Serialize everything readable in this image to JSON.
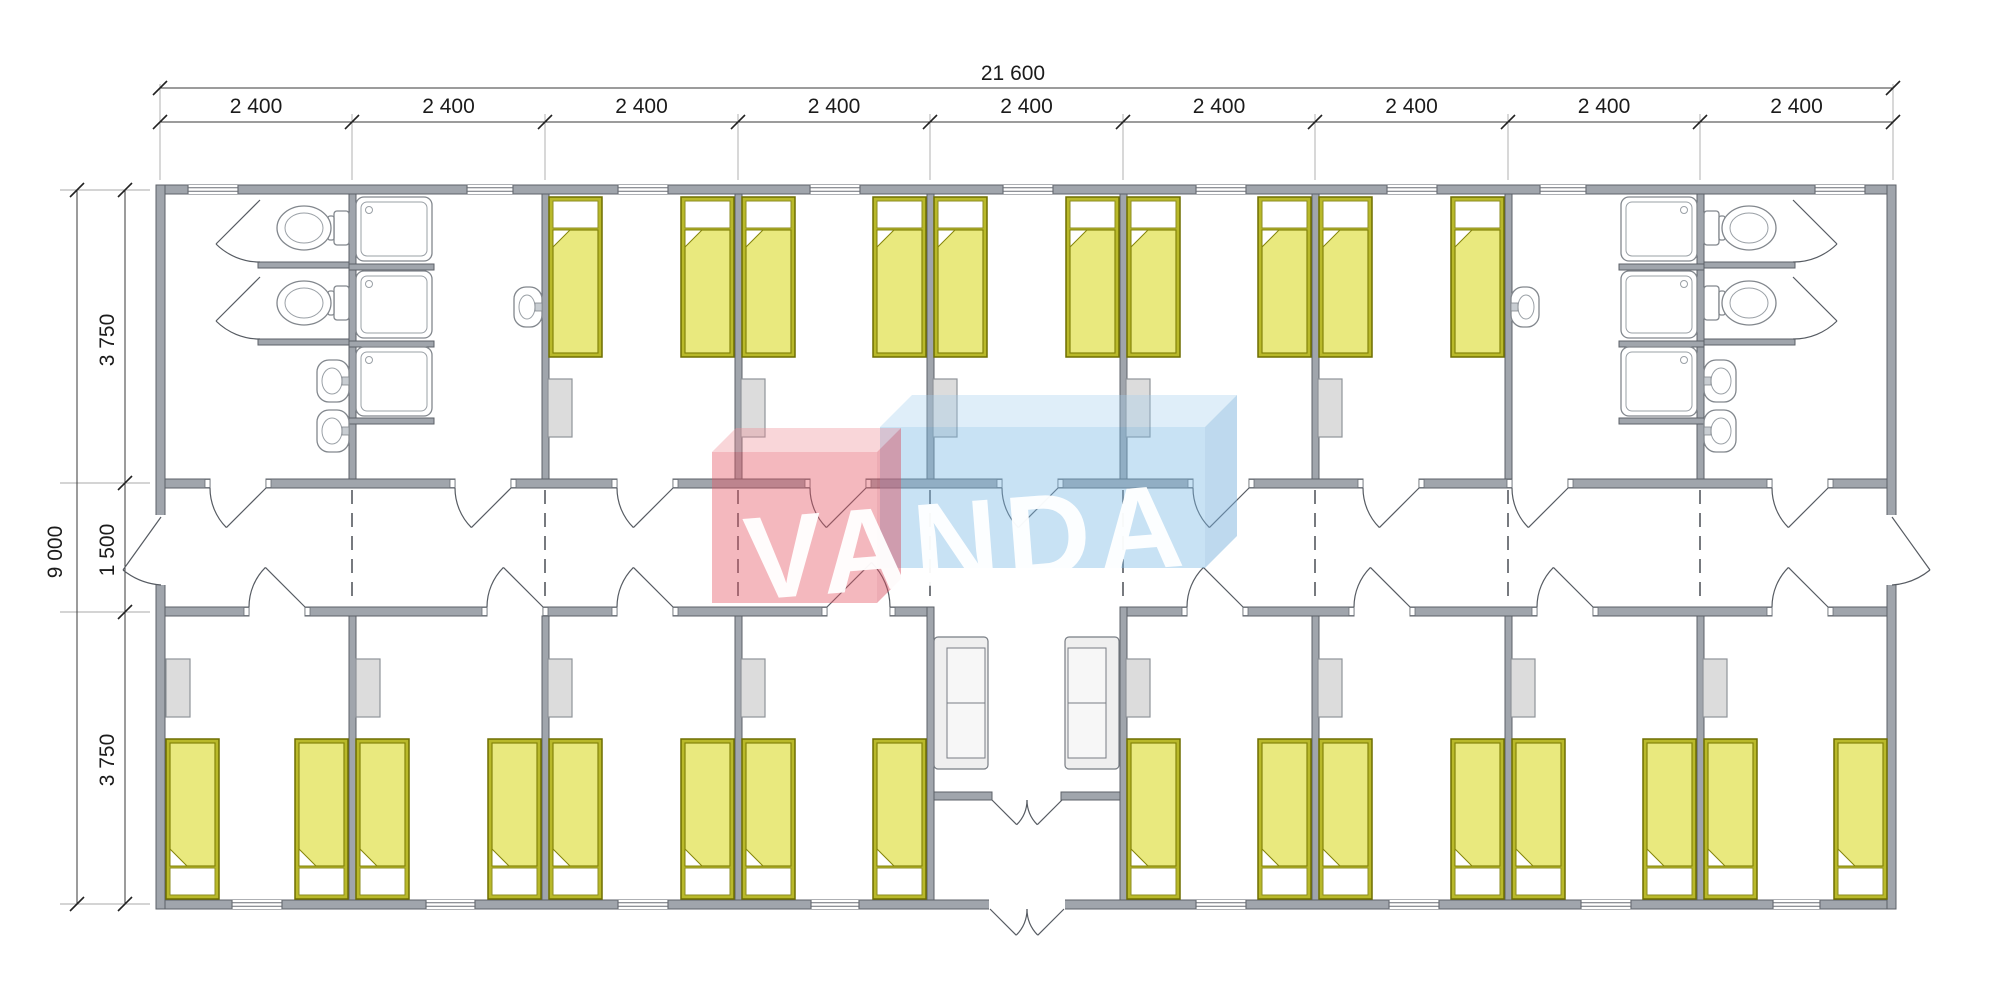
{
  "document": {
    "type": "architectural-floor-plan",
    "watermark": "VANDA"
  },
  "dimensions": {
    "overall_width_label": "21 600",
    "bay_labels": [
      "2 400",
      "2 400",
      "2 400",
      "2 400",
      "2 400",
      "2 400",
      "2 400",
      "2 400",
      "2 400"
    ],
    "overall_height_label": "9 000",
    "vertical_labels": [
      "3 750",
      "1 500",
      "3 750"
    ]
  },
  "plan": {
    "colors": {
      "wall": "#a0a5ac",
      "wall_edge": "#5c6168",
      "bed_frame": "#b9b92a",
      "bed_frame_edge": "#6e6e00",
      "blanket": "#e9e97e",
      "blanket_edge": "#84840a",
      "locker": "#dcdcdc",
      "locker_edge": "#8f949a",
      "sofa": "#efefef",
      "sofa_edge": "#787d84",
      "logo_red_front": "rgba(228,86,100,0.42)",
      "logo_red_top": "rgba(238,140,150,0.36)",
      "logo_red_side": "rgba(215,75,92,0.46)",
      "logo_blue_front": "rgba(125,185,228,0.42)",
      "logo_blue_top": "rgba(160,205,238,0.34)",
      "logo_blue_side": "rgba(120,175,220,0.48)"
    },
    "outer": {
      "x1": 156,
      "x2": 1896,
      "y1": 185,
      "y2": 909,
      "t": 9
    },
    "bays_x": [
      160,
      352,
      545,
      738,
      930,
      1123,
      1315,
      1508,
      1700,
      1893
    ],
    "walls": [
      [
        156,
        185,
        1740,
        9
      ],
      [
        156,
        900,
        1740,
        9
      ],
      [
        156,
        185,
        9,
        724
      ],
      [
        1887,
        185,
        9,
        724
      ],
      [
        349,
        194,
        7,
        285
      ],
      [
        542,
        194,
        7,
        285
      ],
      [
        735,
        194,
        7,
        285
      ],
      [
        927,
        194,
        7,
        285
      ],
      [
        1120,
        194,
        7,
        285
      ],
      [
        1312,
        194,
        7,
        285
      ],
      [
        1505,
        194,
        7,
        285
      ],
      [
        1697,
        194,
        7,
        285
      ],
      [
        349,
        616,
        7,
        284
      ],
      [
        542,
        616,
        7,
        284
      ],
      [
        735,
        616,
        7,
        284
      ],
      [
        1312,
        616,
        7,
        284
      ],
      [
        1505,
        616,
        7,
        284
      ],
      [
        1697,
        616,
        7,
        284
      ],
      [
        927,
        607,
        7,
        293
      ],
      [
        1120,
        607,
        7,
        293
      ],
      [
        258,
        262,
        91,
        6
      ],
      [
        258,
        339,
        91,
        6
      ],
      [
        1704,
        262,
        91,
        6
      ],
      [
        1704,
        339,
        91,
        6
      ],
      [
        349,
        264,
        85,
        6
      ],
      [
        349,
        341,
        85,
        6
      ],
      [
        349,
        418,
        85,
        6
      ],
      [
        1619,
        264,
        85,
        6
      ],
      [
        1619,
        341,
        85,
        6
      ],
      [
        1619,
        418,
        85,
        6
      ],
      [
        934,
        792,
        58,
        8
      ],
      [
        1061,
        792,
        59,
        8
      ]
    ],
    "corridor_top": {
      "y": 479,
      "h": 9,
      "segs": [
        [
          165,
          210
        ],
        [
          266,
          455
        ],
        [
          511,
          617
        ],
        [
          673,
          810
        ],
        [
          866,
          1002
        ],
        [
          1058,
          1193
        ],
        [
          1249,
          1363
        ],
        [
          1419,
          1512
        ],
        [
          1568,
          1772
        ],
        [
          1828,
          1887
        ]
      ]
    },
    "corridor_bottom": {
      "y": 607,
      "h": 9,
      "segs": [
        [
          165,
          249
        ],
        [
          305,
          487
        ],
        [
          543,
          617
        ],
        [
          673,
          827
        ],
        [
          890,
          927
        ],
        [
          1127,
          1187
        ],
        [
          1243,
          1354
        ],
        [
          1410,
          1537
        ],
        [
          1593,
          1772
        ],
        [
          1828,
          1887
        ]
      ]
    },
    "wall_openings": [
      [
        155,
        515,
        11,
        70
      ],
      [
        1886,
        515,
        11,
        70
      ],
      [
        989,
        899,
        76,
        11
      ]
    ],
    "windows_top": [
      [
        188,
        238
      ],
      [
        467,
        513
      ],
      [
        618,
        668
      ],
      [
        810,
        860
      ],
      [
        1003,
        1053
      ],
      [
        1196,
        1246
      ],
      [
        1387,
        1437
      ],
      [
        1540,
        1586
      ],
      [
        1815,
        1865
      ]
    ],
    "windows_bottom": [
      [
        232,
        282
      ],
      [
        426,
        475
      ],
      [
        618,
        668
      ],
      [
        811,
        859
      ],
      [
        1196,
        1246
      ],
      [
        1389,
        1439
      ],
      [
        1581,
        1631
      ],
      [
        1773,
        1820
      ]
    ],
    "doors_top": [
      [
        210,
        266
      ],
      [
        455,
        511
      ],
      [
        617,
        673
      ],
      [
        810,
        866
      ],
      [
        1002,
        1058
      ],
      [
        1193,
        1249
      ],
      [
        1363,
        1419
      ],
      [
        1512,
        1568
      ],
      [
        1772,
        1828
      ]
    ],
    "doors_bottom_R": [
      [
        249,
        305
      ],
      [
        487,
        543
      ],
      [
        617,
        673
      ],
      [
        1187,
        1243
      ],
      [
        1354,
        1410
      ],
      [
        1537,
        1593
      ],
      [
        1772,
        1828
      ]
    ],
    "doors_bottom_L": [
      [
        827,
        890
      ]
    ],
    "stall_doors": [
      {
        "hx": 260,
        "hy": 200,
        "ax": 260,
        "ay": 262,
        "tx": 216,
        "ty": 244,
        "sweep": 1
      },
      {
        "hx": 260,
        "hy": 277,
        "ax": 260,
        "ay": 339,
        "tx": 216,
        "ty": 321,
        "sweep": 1
      },
      {
        "hx": 1793,
        "hy": 200,
        "ax": 1793,
        "ay": 262,
        "tx": 1837,
        "ty": 244,
        "sweep": 0
      },
      {
        "hx": 1793,
        "hy": 277,
        "ax": 1793,
        "ay": 339,
        "tx": 1837,
        "ty": 321,
        "sweep": 0
      }
    ],
    "end_doors": [
      {
        "leaf": [
          161,
          517,
          123,
          570
        ],
        "arc": "M 161 585 A 68 68 0 0 1 123 570"
      },
      {
        "leaf": [
          1892,
          517,
          1930,
          570
        ],
        "arc": "M 1892 585 A 68 68 0 0 0 1930 570"
      }
    ],
    "vestibule_doors": [
      {
        "leaf": [
          992,
          800,
          1016.7,
          824.7
        ],
        "arc": "M 1027 800 A 35 35 0 0 1 1016.7 824.7"
      },
      {
        "leaf": [
          1062,
          800,
          1037.3,
          824.7
        ],
        "arc": "M 1027 800 A 35 35 0 0 0 1037.3 824.7"
      },
      {
        "leaf": [
          990,
          909,
          1016.2,
          935.2
        ],
        "arc": "M 1027 909 A 37 37 0 0 1 1016.2 935.2"
      },
      {
        "leaf": [
          1064,
          909,
          1037.8,
          935.2
        ],
        "arc": "M 1027 909 A 37 37 0 0 0 1037.8 935.2"
      }
    ],
    "beds": {
      "w": 53,
      "h": 160,
      "top_y": 197,
      "bottom_y": 739,
      "top_x": [
        549,
        681,
        742,
        873,
        934,
        1066,
        1127,
        1258,
        1319,
        1451
      ],
      "bottom_x": [
        166,
        295,
        356,
        488,
        549,
        681,
        742,
        873,
        1127,
        1258,
        1319,
        1451,
        1512,
        1643,
        1704,
        1834
      ]
    },
    "lockers": {
      "w": 24,
      "h": 58,
      "top_y": 379,
      "bottom_y": 659,
      "top_x": [
        548,
        741,
        933,
        1126,
        1318
      ],
      "bottom_x": [
        166,
        356,
        548,
        741,
        1126,
        1318,
        1511,
        1703
      ]
    },
    "showers": {
      "w": 76,
      "rows": [
        [
          197,
          64
        ],
        [
          271,
          67
        ],
        [
          347,
          69
        ]
      ],
      "cols": [
        {
          "x": 356,
          "drain": "left"
        },
        {
          "x": 1621,
          "drain": "right"
        }
      ]
    },
    "toilets": [
      {
        "wx": 349,
        "cy": 228,
        "d": -1
      },
      {
        "wx": 349,
        "cy": 303,
        "d": -1
      },
      {
        "wx": 1704,
        "cy": 228,
        "d": 1
      },
      {
        "wx": 1704,
        "cy": 303,
        "d": 1
      }
    ],
    "sinks": [
      {
        "wx": 349,
        "cy": 381,
        "d": -1,
        "small": false
      },
      {
        "wx": 349,
        "cy": 431,
        "d": -1,
        "small": false
      },
      {
        "wx": 1704,
        "cy": 381,
        "d": 1,
        "small": false
      },
      {
        "wx": 1704,
        "cy": 431,
        "d": 1,
        "small": false
      },
      {
        "wx": 542,
        "cy": 307,
        "d": -1,
        "small": true
      },
      {
        "wx": 1511,
        "cy": 307,
        "d": 1,
        "small": true
      }
    ],
    "sofas": [
      {
        "x": 934,
        "y": 637,
        "w": 54,
        "h": 132,
        "back": "l"
      },
      {
        "x": 1065,
        "y": 637,
        "w": 54,
        "h": 132,
        "back": "r"
      }
    ],
    "module_joints": {
      "x": [
        352,
        545,
        738,
        930,
        1123,
        1315,
        1508,
        1700
      ],
      "y1": 490,
      "y2": 605
    },
    "dim_h1": {
      "y": 88,
      "x1": 160,
      "x2": 1893,
      "label_x": 1013,
      "label_y": 80
    },
    "dim_h2": {
      "y": 122,
      "label_y": 113
    },
    "dim_v1": {
      "x": 77,
      "y1": 190,
      "y2": 904,
      "label_x": 62,
      "label_y": 552
    },
    "dim_v2": {
      "x": 125,
      "ticks": [
        190,
        483,
        612,
        904
      ],
      "label_x": 114,
      "label_cy": [
        340,
        550,
        760
      ]
    },
    "logo": {
      "blue_front": [
        880,
        427,
        1205,
        568
      ],
      "blue_top": "880,427 1205,427 1237,395 912,395",
      "blue_side": "1205,427 1237,395 1237,536 1205,568",
      "red_front": [
        712,
        452,
        877,
        603
      ],
      "red_top": "712,452 877,452 901,428 736,428",
      "red_side": "877,452 901,428 901,579 877,603",
      "text_x": 748,
      "text_y": 600,
      "rotate": -4.5
    }
  }
}
